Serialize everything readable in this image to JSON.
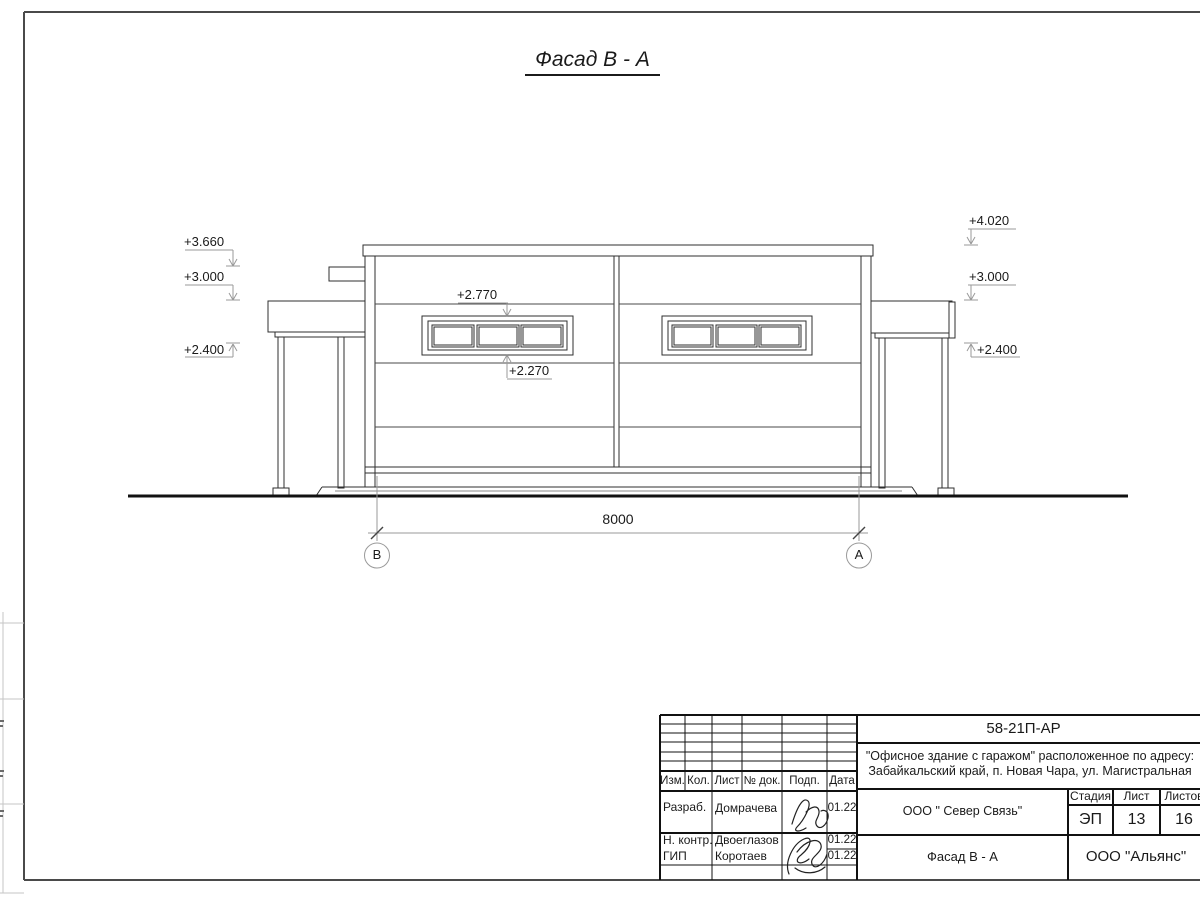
{
  "sheet": {
    "title": "Фасад В - А"
  },
  "annotations": {
    "left": [
      {
        "value": "+3.660"
      },
      {
        "value": "+3.000"
      },
      {
        "value": "+2.400"
      }
    ],
    "right": [
      {
        "value": "+4.020"
      },
      {
        "value": "+3.000"
      },
      {
        "value": "+2.400"
      }
    ],
    "window_top": "+2.770",
    "window_bottom": "+2.270"
  },
  "dimension": {
    "value": "8000"
  },
  "axes": {
    "left": "В",
    "right": "А"
  },
  "title_block": {
    "doc_code": "58-21П-АР",
    "project_line1": "\"Офисное здание с гаражом\" расположенное по адресу:",
    "project_line2": "Забайкальский край, п. Новая Чара, ул. Магистральная",
    "columns": {
      "izm": "Изм.",
      "kol": "Кол.",
      "list": "Лист",
      "doc": "№ док.",
      "podp": "Подп.",
      "data": "Дата"
    },
    "rows": [
      {
        "role": "Разраб.",
        "name": "Домрачева",
        "date": "01.22"
      },
      {
        "role": "Н. контр.",
        "name": "Двоеглазов",
        "date": "01.22"
      },
      {
        "role": "ГИП",
        "name": "Коротаев",
        "date": "01.22"
      }
    ],
    "company": "ООО \" Север Связь\"",
    "stage_label": "Стадия",
    "sheet_label": "Лист",
    "sheets_label": "Листов",
    "stage": "ЭП",
    "sheet_no": "13",
    "sheets_total": "16",
    "view_name": "Фасад В - А",
    "org": "ООО \"Альянс\""
  },
  "colors": {
    "building_line": "#2f2f2f",
    "annotation_line": "#9a9a9a",
    "ground_line": "#111111",
    "frame_line": "#4a4a4a"
  }
}
